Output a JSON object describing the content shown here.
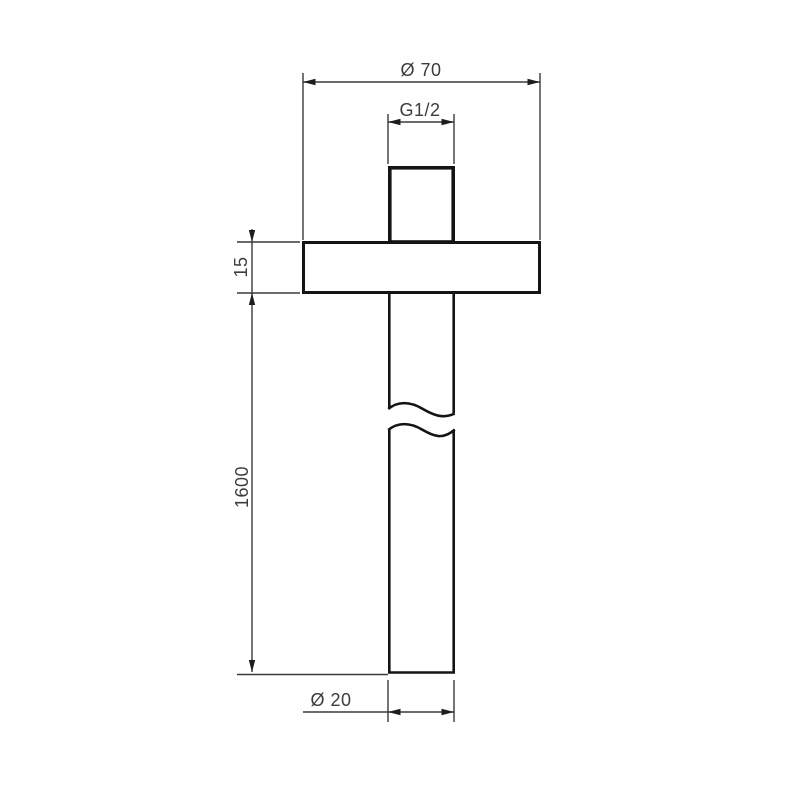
{
  "drawing": {
    "type": "technical-dimension-drawing",
    "subject": "ceiling-mounted shower arm with flange, side elevation",
    "labels": {
      "flange_diameter": "Ø 70",
      "thread_size": "G1/2",
      "flange_thickness": "15",
      "arm_length": "1600",
      "pipe_diameter": "Ø 20"
    },
    "colors": {
      "background": "#ffffff",
      "object_line": "#141414",
      "dimension_line": "#3a3a3a",
      "text": "#3c3c3c"
    }
  }
}
